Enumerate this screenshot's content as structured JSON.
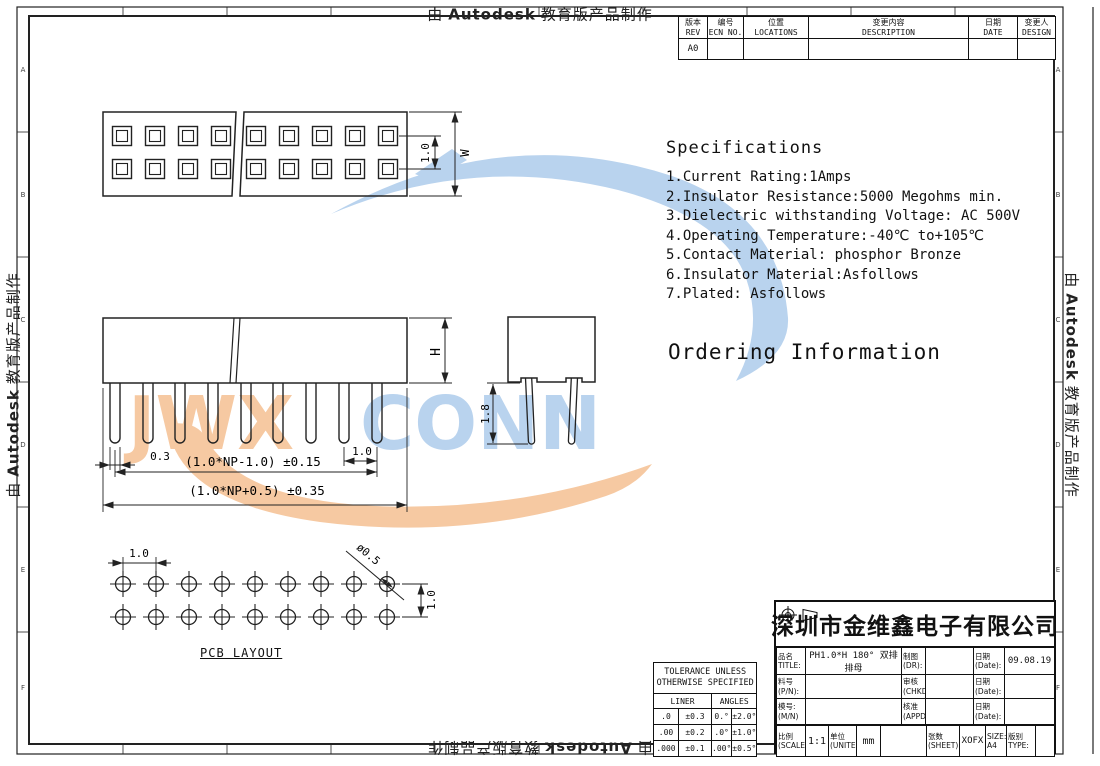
{
  "border": {
    "prefix": "由",
    "brand": "Autodesk",
    "suffix": "教育版产品制作",
    "zone_letters": [
      "A",
      "B",
      "C",
      "D",
      "E",
      "F"
    ]
  },
  "revision_table": {
    "headers": [
      [
        "版本",
        "REV"
      ],
      [
        "编号",
        "ECN NO."
      ],
      [
        "位置",
        "LOCATIONS"
      ],
      [
        "变更内容",
        "DESCRIPTION"
      ],
      [
        "日期",
        "DATE"
      ],
      [
        "变更人",
        "DESIGN"
      ]
    ],
    "first_rev": "A0"
  },
  "specs": {
    "title": "Specifications",
    "items": [
      "1.Current Rating:1Amps",
      "2.Insulator Resistance:5000 Megohms min.",
      "3.Dielectric withstanding Voltage: AC 500V",
      "4.Operating Temperature:-40℃ to+105℃",
      "5.Contact Material: phosphor Bronze",
      "6.Insulator Material:Asfollows",
      "7.Plated: Asfollows"
    ]
  },
  "ordering": {
    "title": "Ordering Information"
  },
  "views": {
    "top_dims": {
      "pitch": "1.0",
      "width": "W"
    },
    "front_dims": {
      "pin_width": "0.3",
      "span": "(1.0*NP-1.0) ±0.15",
      "pitch": "1.0",
      "overall": "(1.0*NP+0.5) ±0.35",
      "height": "H"
    },
    "side_dims": {
      "pin_length": "1.8"
    },
    "pcb": {
      "label": "PCB LAYOUT",
      "pitch_h": "1.0",
      "hole": "ø0.5",
      "pitch_v": "1.0"
    }
  },
  "watermark": {
    "left": "JWX",
    "right": "CONN",
    "left_color": "#f6c9a2",
    "right_color": "#b9d3ee"
  },
  "tolerance": {
    "title1": "TOLERANCE UNLESS",
    "title2": "OTHERWISE SPECIFIED",
    "col1": "LINER",
    "col2": "ANGLES",
    "rows": [
      [
        ".0",
        "±0.3",
        "0.°",
        "±2.0°"
      ],
      [
        ".00",
        "±0.2",
        ".0°",
        "±1.0°"
      ],
      [
        ".000",
        "±0.1",
        ".00°",
        "±0.5°"
      ]
    ]
  },
  "title_block": {
    "company": "深圳市金维鑫电子有限公司",
    "title_label": [
      "品名",
      "TITLE:"
    ],
    "title_value": "PH1.0*H 180° 双排排母",
    "pn_label": [
      "料号",
      "(P/N):"
    ],
    "mn_label": [
      "模号:",
      "(M/N)"
    ],
    "dr_label": [
      "制图",
      "(DR):"
    ],
    "chkd_label": [
      "审核",
      "(CHKD):"
    ],
    "appd_label": [
      "核准",
      "(APPD):"
    ],
    "date_label": [
      "日期",
      "(Date):"
    ],
    "date1": "09.08.19",
    "scale_label": [
      "比例",
      "(SCALE)"
    ],
    "scale": "1:1",
    "unit_label": [
      "单位",
      "(UNITE)"
    ],
    "unit": "mm",
    "sheet_label": [
      "张数",
      "(SHEET):"
    ],
    "sheet": "XOFX",
    "size_label": "SIZE:",
    "size": "A4",
    "type_label": [
      "版别",
      "TYPE:"
    ]
  }
}
